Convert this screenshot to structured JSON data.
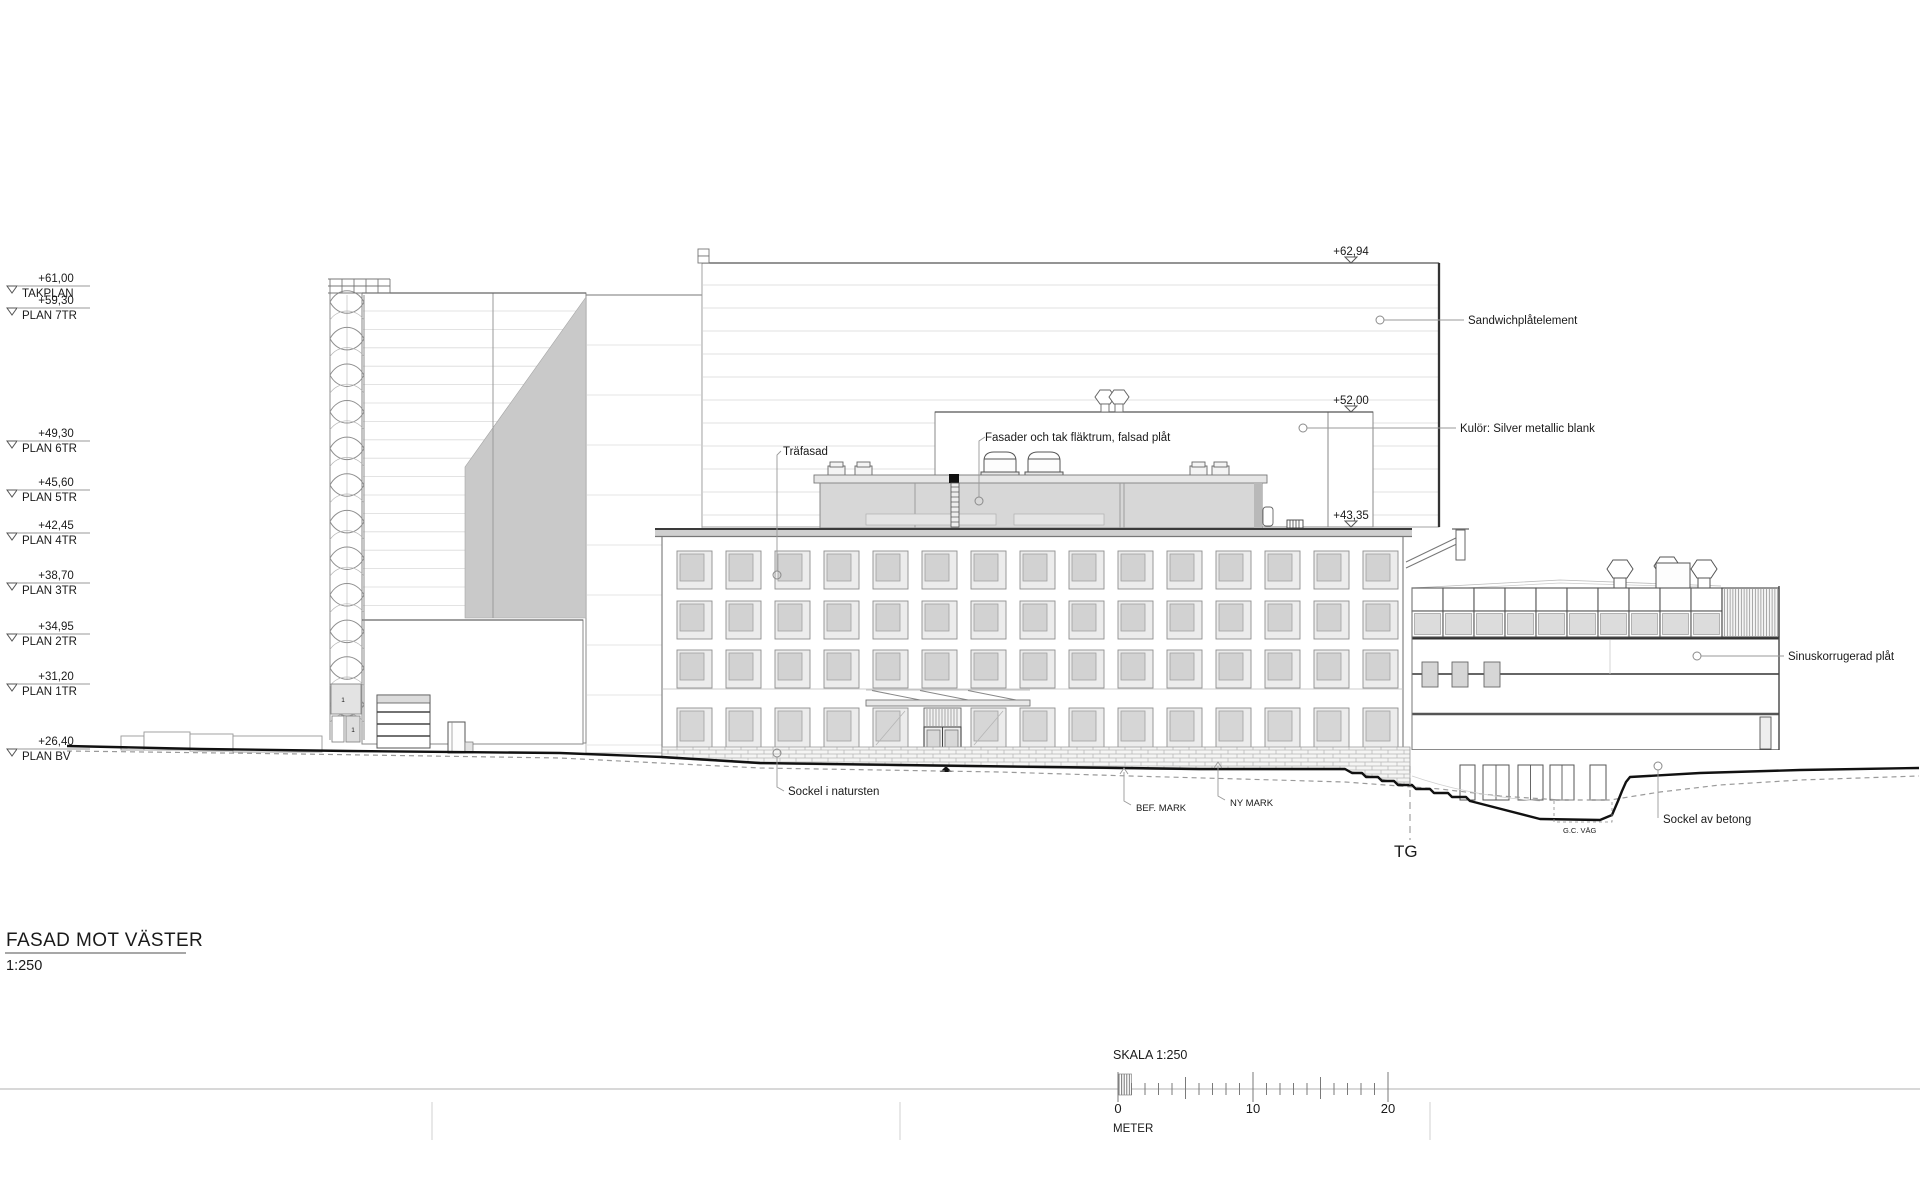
{
  "title_block": {
    "title": "FASAD MOT VÄSTER",
    "scale": "1:250"
  },
  "levels": [
    {
      "name": "TAKPLAN",
      "elevation": "+61,00"
    },
    {
      "name": "PLAN 7TR",
      "elevation": "+59,30"
    },
    {
      "name": "PLAN 6TR",
      "elevation": "+49,30"
    },
    {
      "name": "PLAN 5TR",
      "elevation": "+45,60"
    },
    {
      "name": "PLAN 4TR",
      "elevation": "+42,45"
    },
    {
      "name": "PLAN 3TR",
      "elevation": "+38,70"
    },
    {
      "name": "PLAN 2TR",
      "elevation": "+34,95"
    },
    {
      "name": "PLAN 1TR",
      "elevation": "+31,20"
    },
    {
      "name": "PLAN BV",
      "elevation": "+26,40"
    }
  ],
  "spot_elevations": [
    {
      "value": "+62,94"
    },
    {
      "value": "+52,00"
    },
    {
      "value": "+43,35"
    }
  ],
  "annotations": {
    "sandwich": "Sandwichplåtelement",
    "kulor": "Kulör: Silver metallic blank",
    "trafasad": "Träfasad",
    "flaktrum": "Fasader och tak fläktrum, falsad plåt",
    "sinus": "Sinuskorrugerad plåt",
    "sockel_natursten": "Sockel i natursten",
    "sockel_betong": "Sockel av betong",
    "bef_mark": "BEF. MARK",
    "ny_mark": "NY MARK",
    "tg": "TG",
    "gc_vag": "G.C. VÄG"
  },
  "scale_bar": {
    "label": "SKALA 1:250",
    "tick_0": "0",
    "tick_10": "10",
    "tick_20": "20",
    "unit": "METER"
  },
  "stair_labels": {
    "a": "1",
    "b": "1"
  }
}
